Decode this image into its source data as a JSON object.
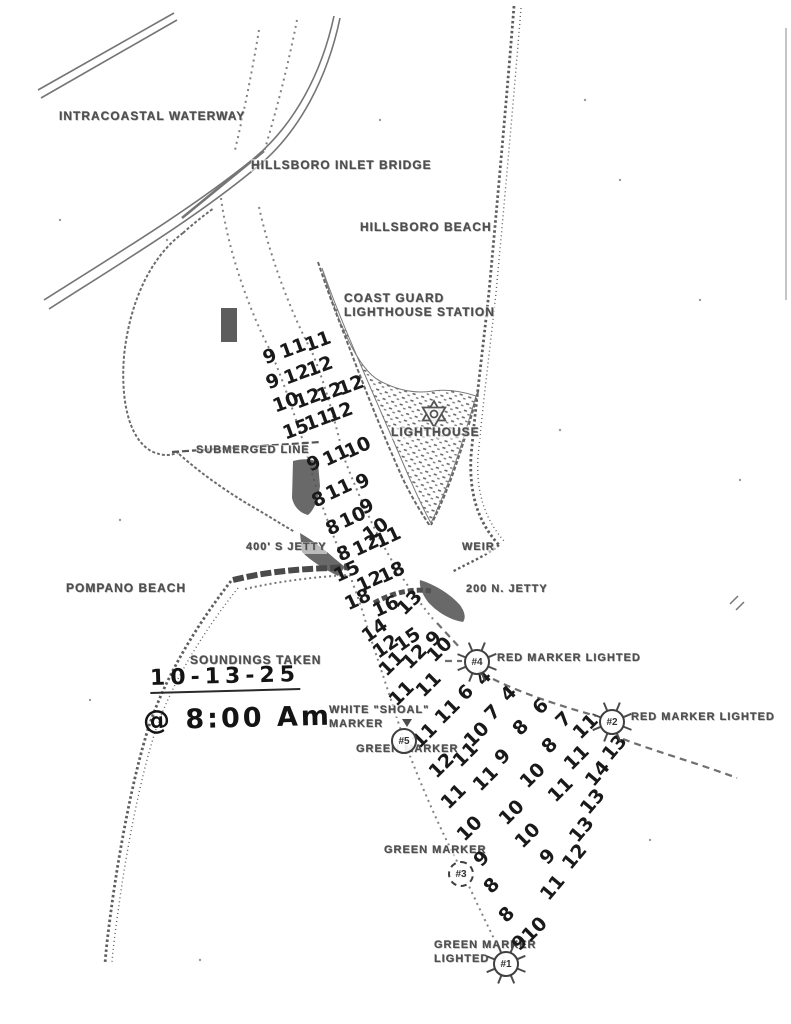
{
  "page_title": "Hillsboro Inlet hand-annotated sounding chart",
  "colors": {
    "paper": "#ffffff",
    "printed_ink": "#4e4e4e",
    "hand_ink": "#141414",
    "scan_gray": "#6e6e6e"
  },
  "notes": {
    "soundings_taken_label": "SOUNDINGS TAKEN",
    "date": "10-13-25",
    "time": "@ 8:00 Am"
  },
  "labels": [
    {
      "id": "intracoastal-waterway",
      "text": "INTRACOASTAL WATERWAY",
      "x": 59,
      "y": 110,
      "fs": 12
    },
    {
      "id": "hillsboro-inlet-bridge",
      "text": "HILLSBORO INLET BRIDGE",
      "x": 251,
      "y": 159,
      "fs": 12
    },
    {
      "id": "hillsboro-beach",
      "text": "HILLSBORO BEACH",
      "x": 360,
      "y": 221,
      "fs": 12
    },
    {
      "id": "coast-guard-station-line1",
      "text": "COAST GUARD",
      "x": 344,
      "y": 292,
      "fs": 12
    },
    {
      "id": "coast-guard-station-line2",
      "text": "LIGHTHOUSE STATION",
      "x": 344,
      "y": 306,
      "fs": 12
    },
    {
      "id": "lighthouse",
      "text": "LIGHTHOUSE",
      "x": 391,
      "y": 426,
      "fs": 12
    },
    {
      "id": "submerged-line",
      "text": "SUBMERGED LINE",
      "x": 196,
      "y": 445,
      "fs": 11
    },
    {
      "id": "s-jetty",
      "text": "400' S JETTY",
      "x": 246,
      "y": 542,
      "fs": 11
    },
    {
      "id": "weir",
      "text": "WEIR",
      "x": 462,
      "y": 542,
      "fs": 11
    },
    {
      "id": "n-jetty",
      "text": "200 N. JETTY",
      "x": 466,
      "y": 584,
      "fs": 11
    },
    {
      "id": "pompano-beach",
      "text": "POMPANO BEACH",
      "x": 66,
      "y": 582,
      "fs": 12
    },
    {
      "id": "soundings-taken",
      "text": "SOUNDINGS TAKEN",
      "x": 190,
      "y": 654,
      "fs": 12
    },
    {
      "id": "white-shoal-marker-line1",
      "text": "WHITE \"SHOAL\"",
      "x": 329,
      "y": 705,
      "fs": 11
    },
    {
      "id": "white-shoal-marker-line2",
      "text": "MARKER",
      "x": 329,
      "y": 719,
      "fs": 11
    },
    {
      "id": "green-marker-5",
      "text": "GREEN MARKER",
      "x": 356,
      "y": 744,
      "fs": 11
    },
    {
      "id": "red-marker-4",
      "text": "RED MARKER LIGHTED",
      "x": 497,
      "y": 653,
      "fs": 11
    },
    {
      "id": "red-marker-2",
      "text": "RED MARKER LIGHTED",
      "x": 631,
      "y": 712,
      "fs": 11
    },
    {
      "id": "green-marker-3",
      "text": "GREEN MARKER",
      "x": 384,
      "y": 845,
      "fs": 11
    },
    {
      "id": "green-marker-1-line1",
      "text": "GREEN MARKER",
      "x": 434,
      "y": 940,
      "fs": 11
    },
    {
      "id": "green-marker-1-line2",
      "text": "LIGHTED",
      "x": 434,
      "y": 954,
      "fs": 11
    }
  ],
  "handwritten": [
    {
      "id": "sounding-date",
      "text": "10-13-25",
      "x": 150,
      "y": 664,
      "fs": 22,
      "ls": 5,
      "underline": true
    },
    {
      "id": "sounding-time",
      "text": "@ 8:00 Am",
      "x": 143,
      "y": 703,
      "fs": 27,
      "ls": 3,
      "underline": false
    }
  ],
  "markers": [
    {
      "id": "4",
      "label": "#4",
      "x": 477,
      "y": 662,
      "lighted": true,
      "dashed": false,
      "flag": false
    },
    {
      "id": "2",
      "label": "#2",
      "x": 612,
      "y": 722,
      "lighted": true,
      "dashed": false,
      "flag": false
    },
    {
      "id": "5",
      "label": "#5",
      "x": 404,
      "y": 741,
      "lighted": false,
      "dashed": false,
      "flag": true
    },
    {
      "id": "3",
      "label": "#3",
      "x": 461,
      "y": 874,
      "lighted": false,
      "dashed": true,
      "flag": false
    },
    {
      "id": "1",
      "label": "#1",
      "x": 506,
      "y": 964,
      "lighted": true,
      "dashed": false,
      "flag": false
    }
  ],
  "soundings": [
    {
      "v": "9",
      "x": 270,
      "y": 357,
      "r": -20
    },
    {
      "v": "11",
      "x": 293,
      "y": 349,
      "r": -20
    },
    {
      "v": "11",
      "x": 318,
      "y": 342,
      "r": -20
    },
    {
      "v": "9",
      "x": 273,
      "y": 382,
      "r": -20
    },
    {
      "v": "12",
      "x": 297,
      "y": 375,
      "r": -20
    },
    {
      "v": "12",
      "x": 320,
      "y": 367,
      "r": -20
    },
    {
      "v": "10",
      "x": 286,
      "y": 403,
      "r": -20
    },
    {
      "v": "12",
      "x": 308,
      "y": 399,
      "r": -20
    },
    {
      "v": "12",
      "x": 330,
      "y": 393,
      "r": -20
    },
    {
      "v": "12",
      "x": 351,
      "y": 386,
      "r": -20
    },
    {
      "v": "15",
      "x": 296,
      "y": 430,
      "r": -20
    },
    {
      "v": "11",
      "x": 318,
      "y": 421,
      "r": -20
    },
    {
      "v": "12",
      "x": 340,
      "y": 413,
      "r": -20
    },
    {
      "v": "9",
      "x": 314,
      "y": 464,
      "r": -25
    },
    {
      "v": "11",
      "x": 336,
      "y": 456,
      "r": -25
    },
    {
      "v": "10",
      "x": 358,
      "y": 448,
      "r": -25
    },
    {
      "v": "9",
      "x": 363,
      "y": 482,
      "r": -25
    },
    {
      "v": "8",
      "x": 319,
      "y": 500,
      "r": -25
    },
    {
      "v": "11",
      "x": 339,
      "y": 490,
      "r": -25
    },
    {
      "v": "9",
      "x": 367,
      "y": 507,
      "r": -25
    },
    {
      "v": "8",
      "x": 333,
      "y": 528,
      "r": -25
    },
    {
      "v": "10",
      "x": 353,
      "y": 518,
      "r": -25
    },
    {
      "v": "10",
      "x": 376,
      "y": 530,
      "r": -35
    },
    {
      "v": "8",
      "x": 344,
      "y": 554,
      "r": -25
    },
    {
      "v": "12",
      "x": 366,
      "y": 546,
      "r": -25
    },
    {
      "v": "11",
      "x": 388,
      "y": 538,
      "r": -25
    },
    {
      "v": "15",
      "x": 347,
      "y": 572,
      "r": -25
    },
    {
      "v": "12",
      "x": 370,
      "y": 582,
      "r": -25
    },
    {
      "v": "18",
      "x": 392,
      "y": 573,
      "r": -25
    },
    {
      "v": "18",
      "x": 358,
      "y": 600,
      "r": -25
    },
    {
      "v": "16",
      "x": 386,
      "y": 607,
      "r": -25
    },
    {
      "v": "13",
      "x": 410,
      "y": 603,
      "r": -45
    },
    {
      "v": "14",
      "x": 375,
      "y": 631,
      "r": -35
    },
    {
      "v": "12",
      "x": 386,
      "y": 647,
      "r": -35
    },
    {
      "v": "15",
      "x": 408,
      "y": 640,
      "r": -35
    },
    {
      "v": "9",
      "x": 434,
      "y": 639,
      "r": -45
    },
    {
      "v": "11",
      "x": 392,
      "y": 664,
      "r": -45
    },
    {
      "v": "12",
      "x": 415,
      "y": 657,
      "r": -45
    },
    {
      "v": "10",
      "x": 440,
      "y": 650,
      "r": -45
    },
    {
      "v": "11",
      "x": 402,
      "y": 694,
      "r": -45
    },
    {
      "v": "11",
      "x": 429,
      "y": 685,
      "r": -45
    },
    {
      "v": "6",
      "x": 466,
      "y": 693,
      "r": -45
    },
    {
      "v": "4",
      "x": 484,
      "y": 678,
      "r": -45
    },
    {
      "v": "11",
      "x": 425,
      "y": 736,
      "r": -45
    },
    {
      "v": "11",
      "x": 448,
      "y": 712,
      "r": -45
    },
    {
      "v": "7",
      "x": 493,
      "y": 713,
      "r": -45
    },
    {
      "v": "4",
      "x": 509,
      "y": 694,
      "r": -45
    },
    {
      "v": "12",
      "x": 442,
      "y": 766,
      "r": -45
    },
    {
      "v": "11",
      "x": 466,
      "y": 755,
      "r": -45
    },
    {
      "v": "10",
      "x": 477,
      "y": 735,
      "r": -45
    },
    {
      "v": "8",
      "x": 521,
      "y": 728,
      "r": -45
    },
    {
      "v": "6",
      "x": 541,
      "y": 707,
      "r": -45
    },
    {
      "v": "7",
      "x": 564,
      "y": 720,
      "r": -45
    },
    {
      "v": "11",
      "x": 454,
      "y": 797,
      "r": -45
    },
    {
      "v": "11",
      "x": 486,
      "y": 779,
      "r": -45
    },
    {
      "v": "9",
      "x": 503,
      "y": 757,
      "r": -45
    },
    {
      "v": "8",
      "x": 550,
      "y": 746,
      "r": -45
    },
    {
      "v": "11",
      "x": 577,
      "y": 758,
      "r": -45
    },
    {
      "v": "11",
      "x": 586,
      "y": 727,
      "r": -45
    },
    {
      "v": "13",
      "x": 615,
      "y": 748,
      "r": -50
    },
    {
      "v": "10",
      "x": 470,
      "y": 829,
      "r": -45
    },
    {
      "v": "10",
      "x": 512,
      "y": 813,
      "r": -45
    },
    {
      "v": "10",
      "x": 533,
      "y": 776,
      "r": -45
    },
    {
      "v": "11",
      "x": 561,
      "y": 790,
      "r": -45
    },
    {
      "v": "14",
      "x": 598,
      "y": 774,
      "r": -50
    },
    {
      "v": "9",
      "x": 482,
      "y": 859,
      "r": -45
    },
    {
      "v": "10",
      "x": 528,
      "y": 836,
      "r": -45
    },
    {
      "v": "13",
      "x": 582,
      "y": 830,
      "r": -50
    },
    {
      "v": "13",
      "x": 593,
      "y": 802,
      "r": -50
    },
    {
      "v": "8",
      "x": 492,
      "y": 886,
      "r": -45
    },
    {
      "v": "9",
      "x": 548,
      "y": 857,
      "r": -45
    },
    {
      "v": "12",
      "x": 575,
      "y": 857,
      "r": -50
    },
    {
      "v": "8",
      "x": 507,
      "y": 915,
      "r": -45
    },
    {
      "v": "11",
      "x": 553,
      "y": 888,
      "r": -50
    },
    {
      "v": "9",
      "x": 520,
      "y": 943,
      "r": -45
    },
    {
      "v": "10",
      "x": 535,
      "y": 930,
      "r": -45
    }
  ]
}
